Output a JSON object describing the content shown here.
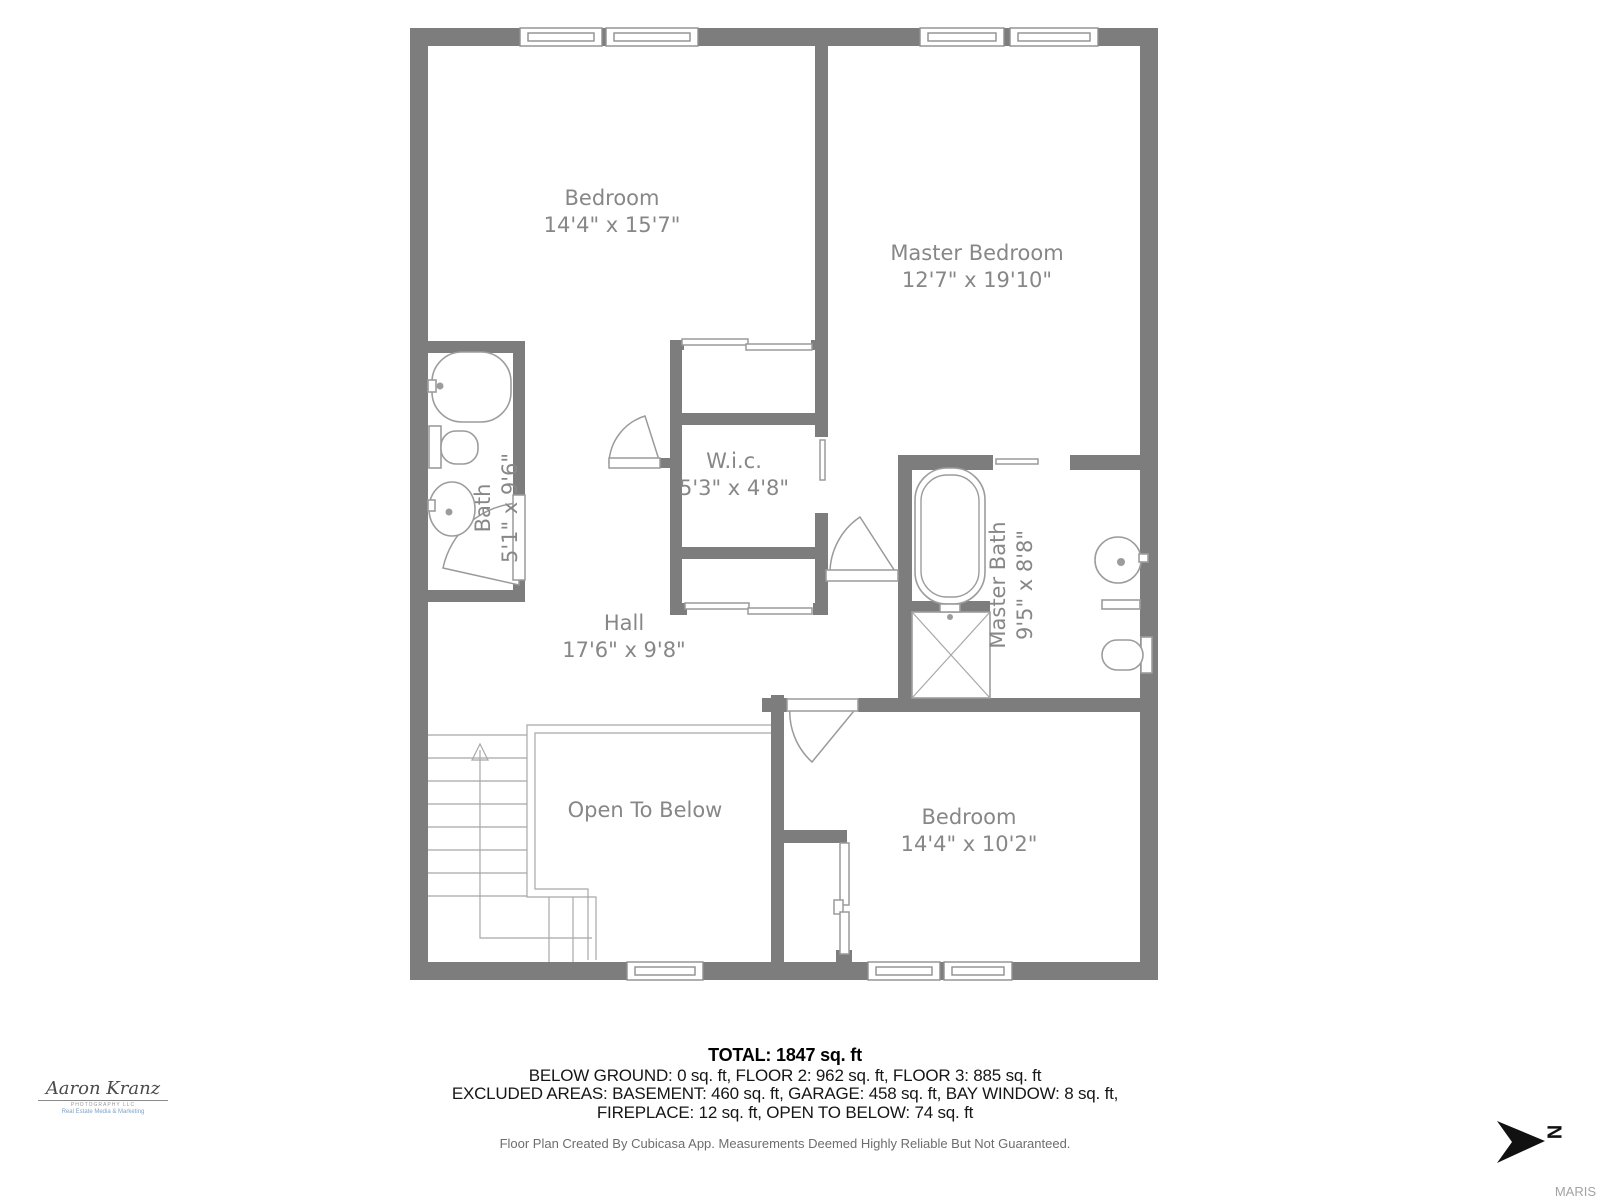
{
  "rooms": [
    {
      "name": "Bedroom",
      "dims": "14'4\" x 15'7\""
    },
    {
      "name": "Master Bedroom",
      "dims": "12'7\" x 19'10\""
    },
    {
      "name": "Bath",
      "dims": "5'1\" x 9'6\""
    },
    {
      "name": "W.i.c.",
      "dims": "5'3\" x 4'8\""
    },
    {
      "name": "Master Bath",
      "dims": "9'5\" x 8'8\""
    },
    {
      "name": "Hall",
      "dims": "17'6\" x 9'8\""
    },
    {
      "name": "Open To Below",
      "dims": ""
    },
    {
      "name": "Bedroom",
      "dims": "14'4\" x 10'2\""
    }
  ],
  "summary": {
    "total": "TOTAL: 1847 sq. ft",
    "line1": "BELOW GROUND: 0 sq. ft, FLOOR 2: 962 sq. ft, FLOOR 3: 885 sq. ft",
    "line2": "EXCLUDED AREAS: BASEMENT: 460 sq. ft, GARAGE: 458 sq. ft, BAY WINDOW: 8 sq. ft,",
    "line3": "FIREPLACE: 12 sq. ft, OPEN TO BELOW: 74 sq. ft",
    "disclaimer": "Floor Plan Created By Cubicasa App. Measurements Deemed Highly Reliable But Not Guaranteed."
  },
  "branding": {
    "name": "Aaron Kranz",
    "tagline1": "PHOTOGRAPHY LLC",
    "tagline2": "Real Estate Media & Marketing"
  },
  "compass": {
    "label": "N"
  },
  "watermark": {
    "label": "MARIS"
  },
  "colors": {
    "wall": "#7d7d7d",
    "fixture": "#9c9c9c",
    "label": "#878787",
    "ink": "#161616",
    "muted": "#6d6d6d",
    "brand": "#7da3c6",
    "wm": "#a3a3a3"
  }
}
